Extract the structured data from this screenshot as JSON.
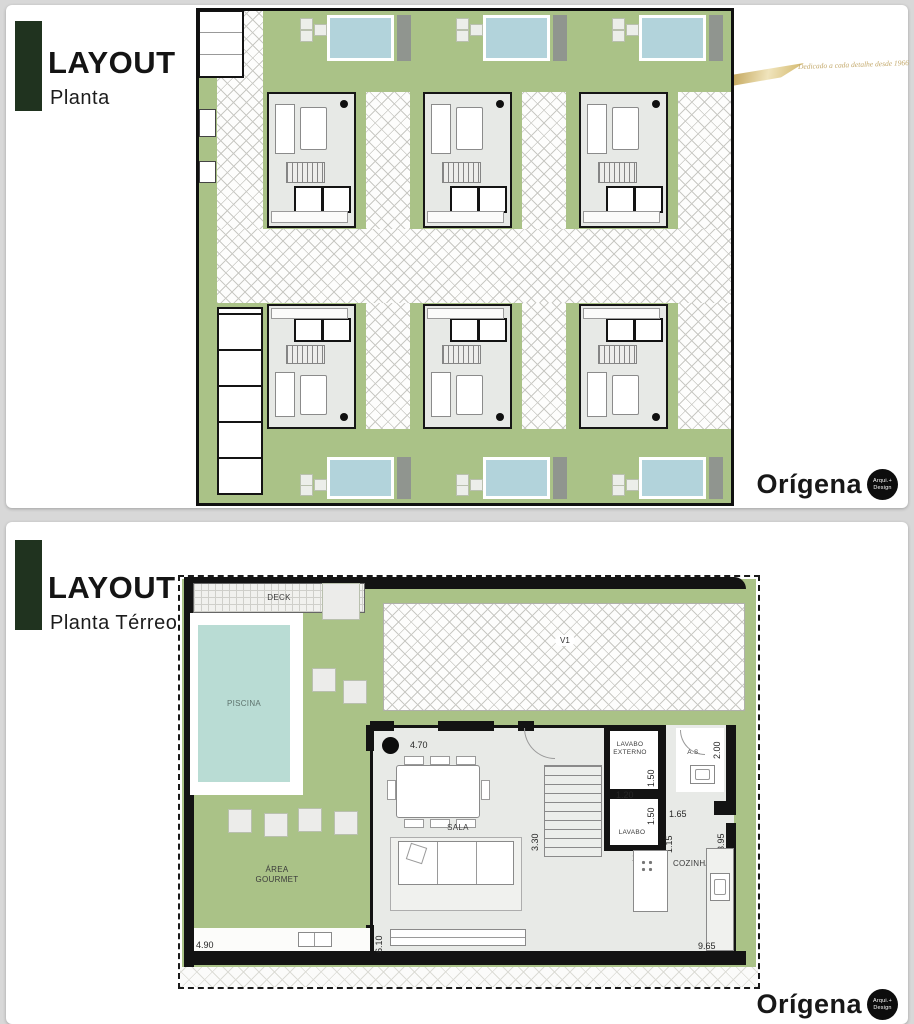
{
  "colors": {
    "page_bg": "#d8d8d8",
    "card_bg": "#ffffff",
    "accent_bar_green": "#20331f",
    "lawn_green": "#aac287",
    "pool_blue": "#b2d3db",
    "pool_teal": "#b9dcd4",
    "floor_gray": "#e8eae7",
    "wall_black": "#131313",
    "gold": "#c4aa6d"
  },
  "top_panel": {
    "title": "LAYOUT",
    "subtitle": "Planta",
    "tagline": "Dedicado a cada detalhe desde 1966",
    "brand": {
      "name": "Orígena",
      "badge_line1": "Arqui.+",
      "badge_line2": "Design"
    }
  },
  "bottom_panel": {
    "title": "LAYOUT",
    "subtitle": "Planta Térreo",
    "brand": {
      "name": "Orígena",
      "badge_line1": "Arqui.+",
      "badge_line2": "Design"
    },
    "floorplan": {
      "labels": {
        "deck": "DECK",
        "piscina": "PISCINA",
        "v1": "V1",
        "sala": "SALA",
        "area_gourmet_line1": "ÁREA",
        "area_gourmet_line2": "GOURMET",
        "lavabo_externo_line1": "LAVABO",
        "lavabo_externo_line2": "EXTERNO",
        "lavabo": "LAVABO",
        "as": "A.S.",
        "cozinha": "COZINHA"
      },
      "dimensions": {
        "sala_width": "4.70",
        "stairs_depth": "3.30",
        "lavabo_externo_depth": "1.50",
        "as_width": "2.00",
        "lavabo_width": "1.20",
        "lavabo_depth": "1.50",
        "hall_width": "1.65",
        "corridor_width": "1.15",
        "cozinha_depth": "3.95",
        "lavabo_door": "1.50",
        "gourmet_width": "4.90",
        "sala_depth": "6.10",
        "cozinha_width": "9.65"
      }
    }
  }
}
